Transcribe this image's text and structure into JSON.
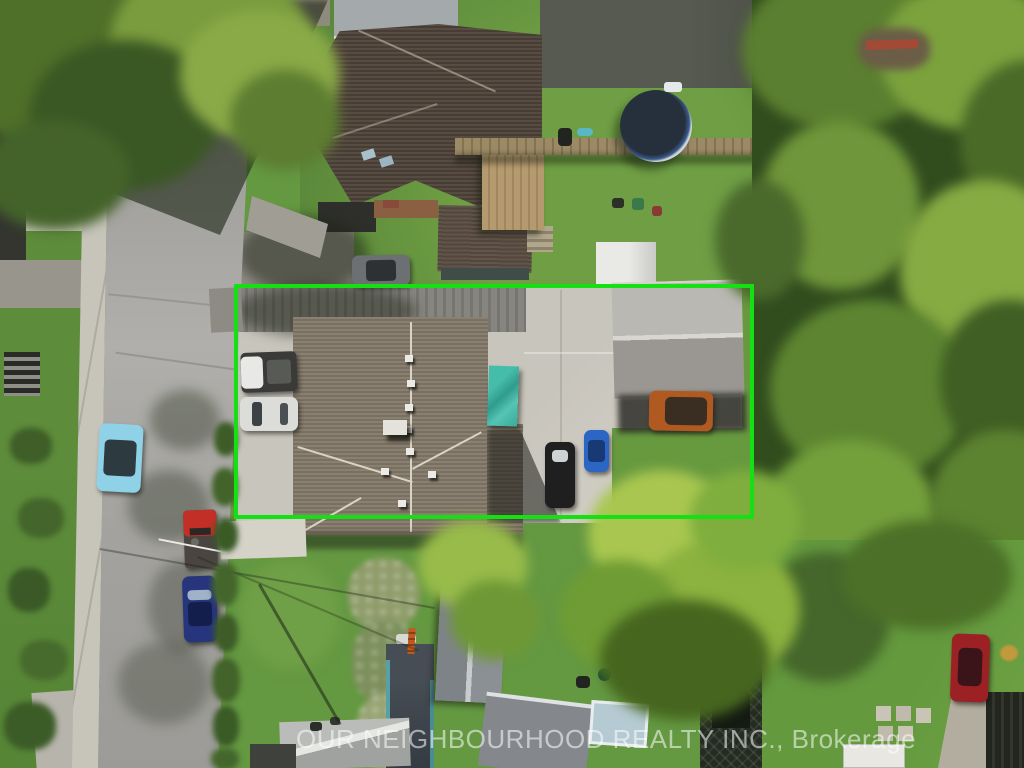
{
  "watermark": {
    "text": "OUR NEIGHBOURHOOD REALTY INC., Brokerage",
    "color": "#ffffff",
    "opacity": 0.55
  },
  "annotation": {
    "name": "property-boundary-outline",
    "shape": "rectangle",
    "color": "#14e014"
  },
  "scene": {
    "type": "aerial-drone-photo-real-estate",
    "objects": [
      "residential-street",
      "sidewalk",
      "subject-house-roof",
      "teal-awning",
      "detached-garage",
      "concrete-driveway",
      "white-pickup-truck",
      "white-car",
      "black-car",
      "small-blue-car",
      "orange-suv",
      "grey-car",
      "cyan-car-on-street",
      "red-pickup-on-street",
      "dark-blue-car-on-street",
      "neighbor-house-roof",
      "above-ground-pool",
      "wood-deck",
      "privacy-fence",
      "white-canopy-tent",
      "backyard-lawn",
      "utility-pole-shadow",
      "garden-shed",
      "grey-gable-roof-house",
      "red-car-bottom-right",
      "paving-stones",
      "tree-canopy",
      "forest",
      "blossoming-hedge"
    ],
    "palette": {
      "asphalt_road": "#a5a4a0",
      "concrete": "#cbc8bf",
      "grass": "#649841",
      "forest_dark": "#314d1e",
      "subject_roof_brown": "#847969",
      "garage_roof_grey": "#b2b0ab",
      "neighbor_roof_darkbrown": "#4e4238",
      "awning_teal": "#3ab0a0",
      "pool_cover_navy": "#26303c"
    }
  }
}
